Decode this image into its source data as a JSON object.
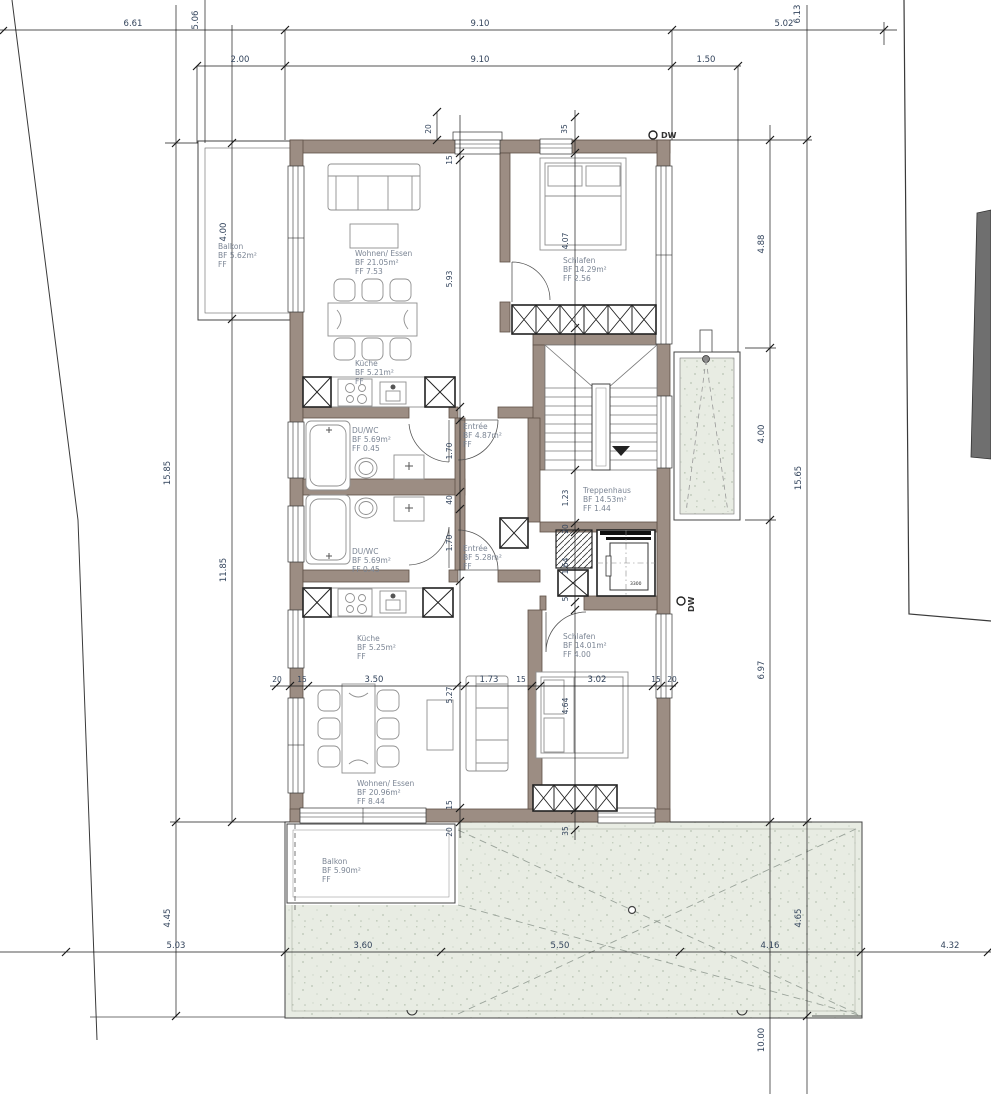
{
  "colors": {
    "wall": "#9c8d83",
    "wall_edge": "#5e5046",
    "terrace": "#e8ece3",
    "stipple": "#bcc7b6",
    "site_shape": "#6f6f6f",
    "room_label": "#7b8594",
    "dim_text": "#33445c"
  },
  "rooms": {
    "balkon_top": {
      "name": "Balkon",
      "bf": "BF 5.62m²",
      "ff": "FF"
    },
    "wohnen_top": {
      "name": "Wohnen/ Essen",
      "bf": "BF 21.05m²",
      "ff": "FF 7.53"
    },
    "schlafen_top": {
      "name": "Schlafen",
      "bf": "BF 14.29m²",
      "ff": "FF 2.56"
    },
    "kueche_top": {
      "name": "Küche",
      "bf": "BF 5.21m²",
      "ff": "FF"
    },
    "duwc_top": {
      "name": "DU/WC",
      "bf": "BF 5.69m²",
      "ff": "FF 0.45"
    },
    "entree_top": {
      "name": "Entrée",
      "bf": "BF 4.87m²",
      "ff": "FF"
    },
    "treppenhaus": {
      "name": "Treppenhaus",
      "bf": "BF 14.53m²",
      "ff": "FF 1.44"
    },
    "duwc_bottom": {
      "name": "DU/WC",
      "bf": "BF 5.69m²",
      "ff": "FF 0.45"
    },
    "entree_bottom": {
      "name": "Entrée",
      "bf": "BF 5.28m²",
      "ff": "FF"
    },
    "kueche_bottom": {
      "name": "Küche",
      "bf": "BF 5.25m²",
      "ff": "FF"
    },
    "schlafen_bottom": {
      "name": "Schlafen",
      "bf": "BF 14.01m²",
      "ff": "FF 4.00"
    },
    "wohnen_bottom": {
      "name": "Wohnen/ Essen",
      "bf": "BF 20.96m²",
      "ff": "FF 8.44"
    },
    "balkon_bottom": {
      "name": "Balkon",
      "bf": "BF 5.90m²",
      "ff": "FF"
    }
  },
  "dims": {
    "t1": "6.61",
    "t2": "9.10",
    "t3": "5.02",
    "t4": "2.00",
    "t5": "9.10",
    "t6": "1.50",
    "tv1": "5.06",
    "tv2": "6.13",
    "tw1": "20",
    "tw2": "35",
    "tw3": "15",
    "l1": "15.85",
    "l2": "4.00",
    "l3": "11.85",
    "l4": "4.45",
    "l5": "5.03",
    "r1": "4.88",
    "r2": "4.00",
    "r3": "15.65",
    "r4": "6.97",
    "r5": "4.65",
    "r6": "10.00",
    "r7": "4.32",
    "il1": "5.93",
    "il2": "1.70",
    "il3": "40",
    "il4": "1.70",
    "il5": "5.27",
    "il6": "15",
    "il7": "20",
    "ir1": "4.07",
    "ir2": "1.23",
    "ir3": "20",
    "ir4": "1.64",
    "ir5": "5",
    "ir6": "4.64",
    "ir7": "35",
    "m1": "20",
    "m2": "15",
    "m3": "3.50",
    "m4": "1.73",
    "m5": "15",
    "m6": "3.02",
    "m7": "15",
    "m8": "20",
    "b1": "3.60",
    "b2": "5.50",
    "b3": "4.16"
  },
  "markers": {
    "dw1": "DW",
    "dw2": "DW",
    "lift": "3300"
  }
}
